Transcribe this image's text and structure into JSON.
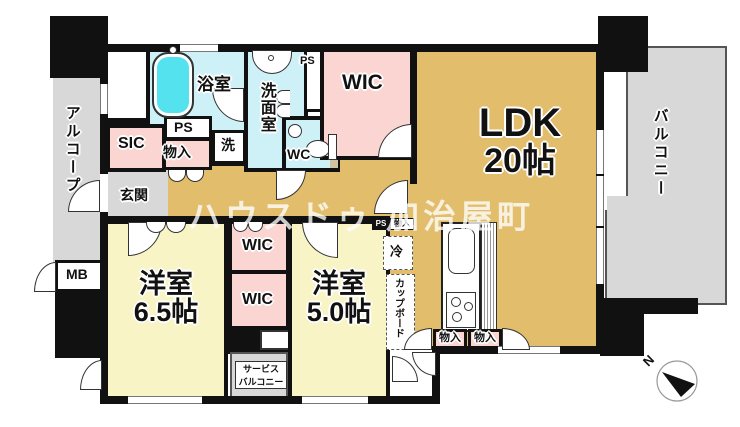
{
  "floorplan": {
    "watermark": "ハウスドゥ 加治屋町",
    "compass_label": "N",
    "labels": {
      "alcove": "アルコープ",
      "bath": "浴室",
      "senmen": "洗面室",
      "ps_top": "PS",
      "ps_mid": "PS",
      "mono_entrance": "物入",
      "laundry": "洗",
      "wc": "WC",
      "sic": "SIC",
      "genkan": "玄関",
      "wic_top": "WIC",
      "ldk_name": "LDK",
      "ldk_size": "20帖",
      "balcony": "バルコニー",
      "mb": "MB",
      "yo65_name": "洋室",
      "yo65_size": "6.5帖",
      "wic_mid1": "WIC",
      "wic_mid2": "WIC",
      "yo50_name": "洋室",
      "yo50_size": "5.0帖",
      "svc_line1": "サービス",
      "svc_line2": "バルコニー",
      "ps_mono_ps": "PS",
      "ps_mono_mono": "物入",
      "fridge": "冷",
      "cupboard": "カップボード",
      "mono_k1": "物入",
      "mono_k2": "物入"
    },
    "colors": {
      "ldk_tan": "#E2BE6C",
      "bedroom_yellow": "#F8F4C6",
      "closet_pink": "#FAD5D1",
      "wet_cyan": "#CDF1F7",
      "tub_cyan": "#54E2EF",
      "outdoor_gray": "#D8D8D8",
      "wall_black": "#111111",
      "shelf_beige": "#CFC3A4",
      "watermark_white": "rgba(255,255,255,0.78)"
    }
  }
}
